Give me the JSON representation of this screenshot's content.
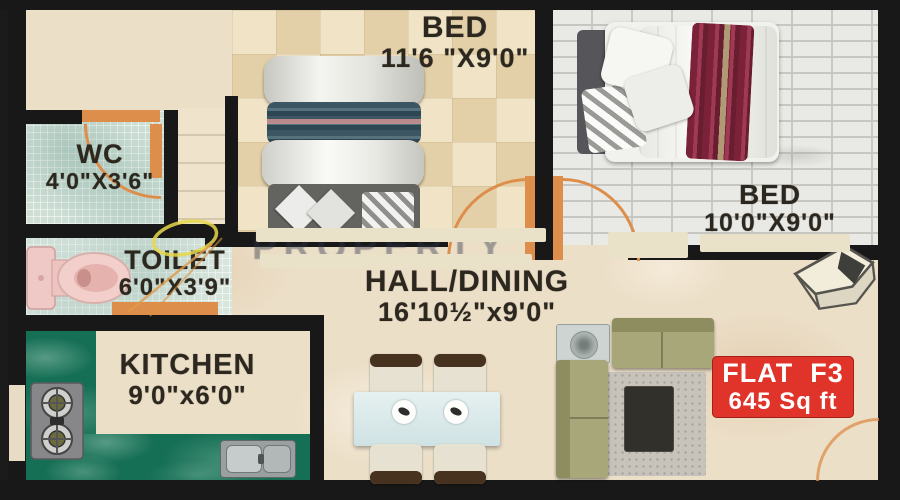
{
  "title": "Flat F3 floor plan",
  "flat_badge": {
    "line1": "FLAT  F3",
    "line2": "645 Sq ft"
  },
  "rooms": {
    "bed1": {
      "name": "BED",
      "dims": "11'6 \"X9'0\""
    },
    "bed2": {
      "name": "BED",
      "dims": "10'0\"X9'0\""
    },
    "wc": {
      "name": "WC",
      "dims": "4'0\"X3'6\""
    },
    "toilet": {
      "name": "TOILET",
      "dims": "6'0\"X3'9\""
    },
    "kitchen": {
      "name": "KITCHEN",
      "dims": "9'0\"x6'0\""
    },
    "hall": {
      "name": "HALL/DINING",
      "dims": "16'10½\"x9'0\""
    }
  },
  "watermark": "PROPERTY",
  "colors": {
    "wall": "#181818",
    "door_accent": "#dd8e4a",
    "badge_bg": "#e0342a",
    "badge_fg": "#ffffff",
    "kitchen_counter": "#156f54",
    "sofa": "#a8a779",
    "annotation_yellow": "#e6d84a"
  }
}
